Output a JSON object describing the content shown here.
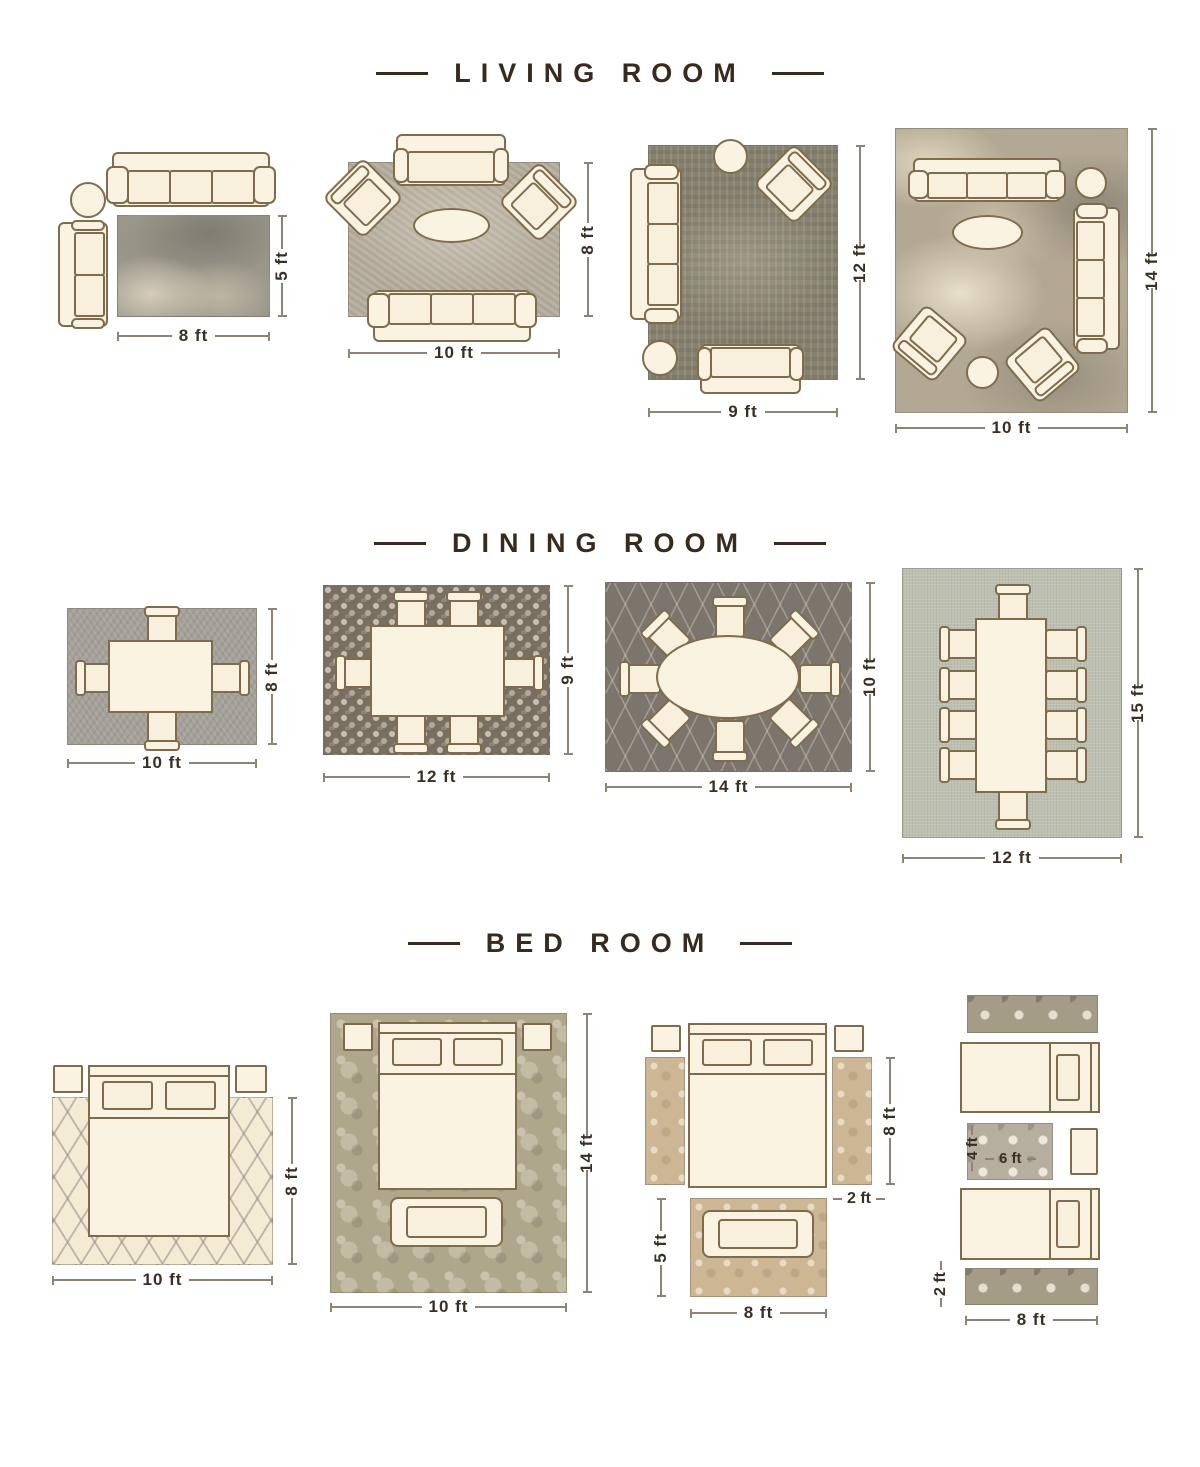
{
  "palette": {
    "title_color": "#382b1d",
    "dim_text": "#3a2f23",
    "dim_line": "#8d8474",
    "furniture_fill": "#fbf3e2",
    "furniture_outline": "#7f6c4d",
    "background": "#ffffff"
  },
  "sections": {
    "living": {
      "title": "LIVING ROOM",
      "layouts": [
        {
          "rug": "5x8",
          "width_label": "8 ft",
          "height_label": "5 ft",
          "furniture": [
            "three-seat-sofa",
            "round-side-table",
            "loveseat"
          ]
        },
        {
          "rug": "8x10",
          "width_label": "10 ft",
          "height_label": "8 ft",
          "furniture": [
            "loveseat",
            "armchair",
            "armchair",
            "oval-coffee-table",
            "three-seat-sofa"
          ]
        },
        {
          "rug": "9x12",
          "width_label": "9 ft",
          "height_label": "12 ft",
          "furniture": [
            "three-seat-sofa",
            "round-side-table",
            "armchair",
            "round-side-table",
            "loveseat"
          ]
        },
        {
          "rug": "10x14",
          "width_label": "10 ft",
          "height_label": "14 ft",
          "furniture": [
            "three-seat-sofa",
            "round-side-table",
            "three-seat-sofa",
            "oval-coffee-table",
            "armchair",
            "armchair",
            "round-side-table"
          ]
        }
      ]
    },
    "dining": {
      "title": "DINING ROOM",
      "layouts": [
        {
          "rug": "8x10",
          "width_label": "10 ft",
          "height_label": "8 ft",
          "furniture": [
            "dining-table",
            "four-chairs"
          ]
        },
        {
          "rug": "9x12",
          "width_label": "12 ft",
          "height_label": "9 ft",
          "furniture": [
            "dining-table",
            "six-chairs"
          ]
        },
        {
          "rug": "10x14",
          "width_label": "14 ft",
          "height_label": "10 ft",
          "furniture": [
            "oval-dining-table",
            "eight-chairs"
          ]
        },
        {
          "rug": "12x15",
          "width_label": "12 ft",
          "height_label": "15 ft",
          "furniture": [
            "dining-table",
            "ten-chairs"
          ]
        }
      ]
    },
    "bed": {
      "title": "BED ROOM",
      "layouts": [
        {
          "rug": "8x10",
          "width_label": "10 ft",
          "height_label": "8 ft",
          "furniture": [
            "queen-bed",
            "nightstand",
            "nightstand"
          ]
        },
        {
          "rug": "10x14",
          "width_label": "10 ft",
          "height_label": "14 ft",
          "furniture": [
            "queen-bed",
            "nightstand",
            "nightstand",
            "bench"
          ]
        },
        {
          "rug": "5x8-plus-runners",
          "width_label": "8 ft",
          "runner_height_label": "8 ft",
          "runner_width_label": "2 ft",
          "foot_rug_height_label": "5 ft",
          "furniture": [
            "queen-bed",
            "nightstand",
            "nightstand",
            "runner-rug",
            "runner-rug",
            "bench"
          ]
        },
        {
          "rug": "4x6-plus-runners",
          "width_label": "8 ft",
          "runner_height_label": "2 ft",
          "center_rug_width_label": "6 ft",
          "center_rug_height_label": "4 ft",
          "furniture": [
            "twin-bed",
            "twin-bed",
            "nightstand",
            "runner-rug",
            "runner-rug"
          ]
        }
      ]
    }
  }
}
